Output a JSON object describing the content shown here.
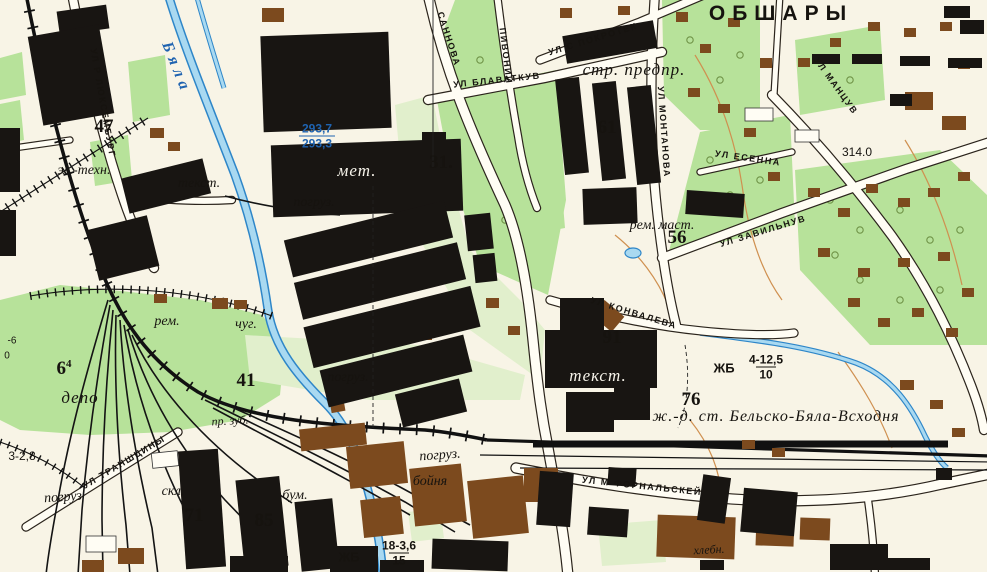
{
  "settlement": {
    "name": "ОБШАРЫ"
  },
  "railway_station": {
    "label": "ж.-д. ст. Бельско-Бяла-Всходня"
  },
  "river": {
    "name": "Бяла",
    "levels": {
      "upper": "293,7",
      "lower": "293,3"
    }
  },
  "block_numbers": {
    "b47": "47",
    "b31": "31.",
    "b61": "61",
    "b56": "56",
    "b91": "91",
    "b76": "76",
    "b41": "41",
    "b71": "71",
    "b85": "85",
    "b6": "6",
    "b6_sup": "4"
  },
  "objects": {
    "el_tehn": "эл.-техн.",
    "tekst_nw": "текст.",
    "met": "мет.",
    "pogruz_n": "погруз.",
    "str_predpr": "стр. предпр.",
    "rem_mast": "рем. маст.",
    "rem": "рем.",
    "chug": "чуг.",
    "pogruz_c": "погруз.",
    "depo": "депо",
    "pr_zub": "пр. зуб.",
    "tekst_s": "текст.",
    "pogruz_s": "погруз.",
    "boynya": "бойня",
    "pogruz_w": "погруз",
    "skl": "скл.",
    "bum": "бум.",
    "hlebn": "хлебн."
  },
  "streets": {
    "luxemburg": "УЛ Р ЛЮКСЕМБУРГ",
    "sannova": "САННОВА",
    "pivonii": "ПИВОНИИ",
    "blavatkuv": "УЛ БЛАВАТКУВ",
    "pokrotek": "УЛ С ПОКРОТЕК",
    "montanova": "УЛ МОНТАНОВА",
    "zavilnuv": "УЛ ЗАВИЛЬНУВ",
    "mantsuv": "УЛ МАНЦУВ",
    "esenna": "УЛ ЕСЕННА",
    "konvaleva": "УЛ КОНВАЛЕВА",
    "transhciny": "УЛ ТРАНШЦИНЫ",
    "fornalskey": "УЛ М ФОРНАЛЬСКЕЙ"
  },
  "elevations": {
    "e314": "314.0",
    "frag_3_28": "3-2,8",
    "frag_m6": "-6",
    "frag_0": "0"
  },
  "bridges": {
    "zhb_e": {
      "material": "ЖБ",
      "num": "4-12,5",
      "den": "10"
    },
    "zhb_s": {
      "material": "ЖБ",
      "num": "18-3,6",
      "den": "15"
    }
  },
  "colors": {
    "paper": "#f8f4e6",
    "green": "#b7e29a",
    "green_pale": "#e1efcc",
    "water_fill": "#a9d9f1",
    "water_line": "#2e86c8",
    "building_black": "#181512",
    "building_brown": "#7c4a1e",
    "road_fill": "#fffdf4",
    "road_casing": "#2b241c",
    "contour": "#cf9050",
    "blue_text": "#1f63b0"
  }
}
